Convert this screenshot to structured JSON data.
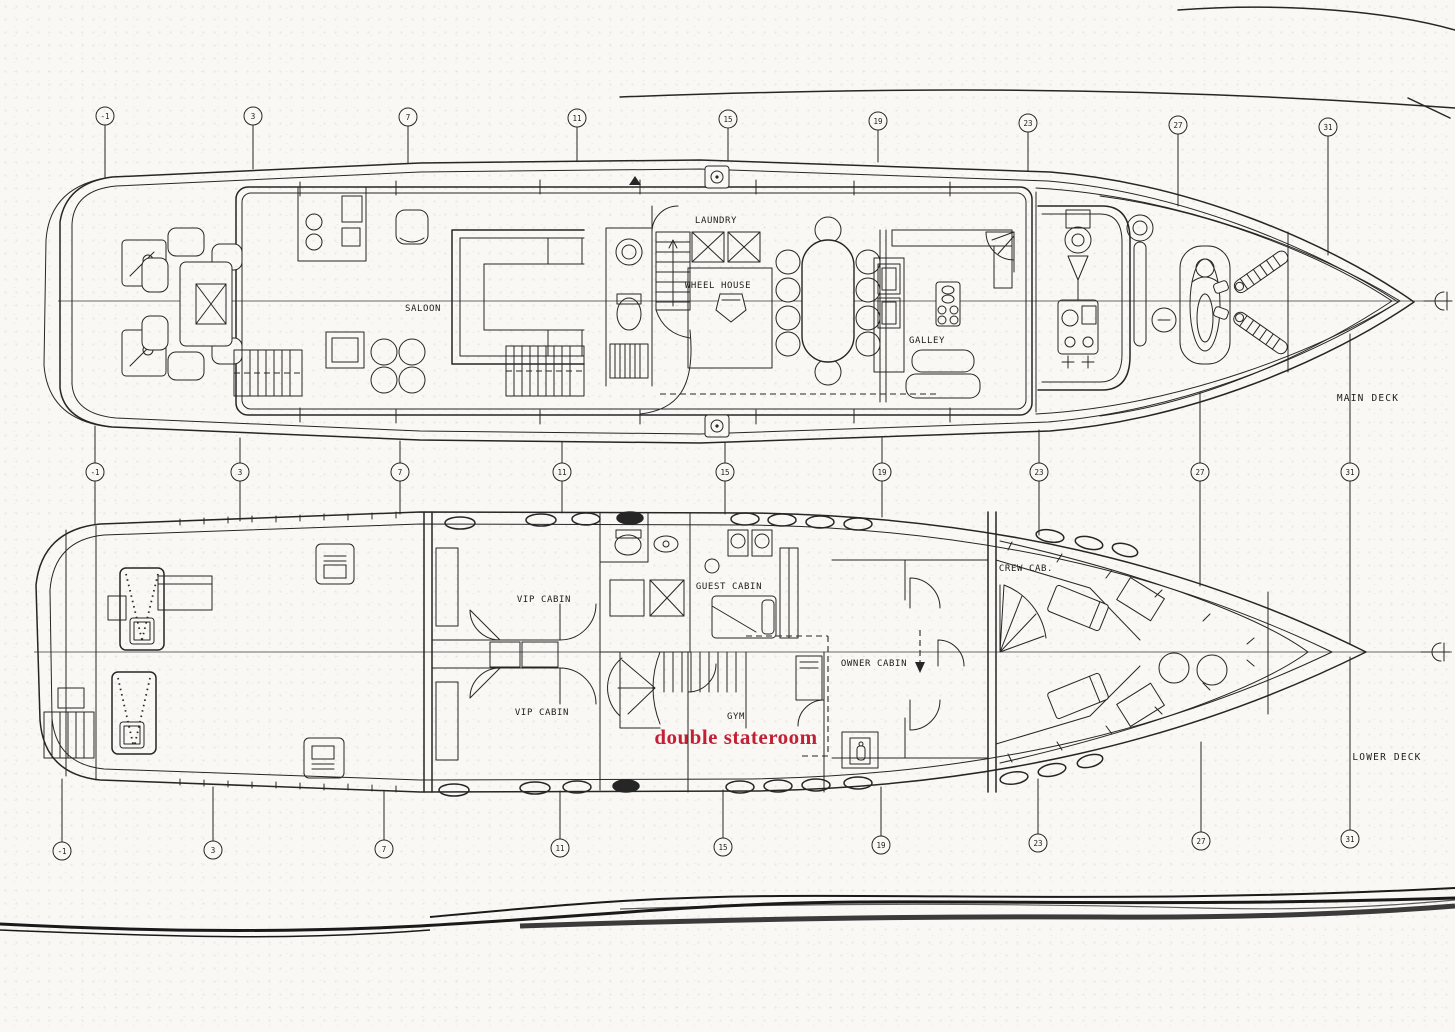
{
  "document": {
    "type": "yacht general arrangement drawing",
    "ink_color": "#262626",
    "annotation_color": "#c32036",
    "paper_color": "#f9f8f4"
  },
  "stations": {
    "labels": [
      "-1",
      "3",
      "7",
      "11",
      "15",
      "19",
      "23",
      "27",
      "31"
    ]
  },
  "main_deck": {
    "title": "MAIN DECK",
    "rooms": {
      "saloon": "SALOON",
      "laundry": "LAUNDRY",
      "wheel_house": "WHEEL HOUSE",
      "galley": "GALLEY"
    }
  },
  "lower_deck": {
    "title": "LOWER DECK",
    "rooms": {
      "vip_cabin": "VIP CABIN",
      "guest_cabin": "GUEST CABIN",
      "owner_cabin": "OWNER CABIN",
      "crew_cabin": "CREW CAB.",
      "gym": "GYM"
    },
    "annotation": "double stateroom"
  }
}
